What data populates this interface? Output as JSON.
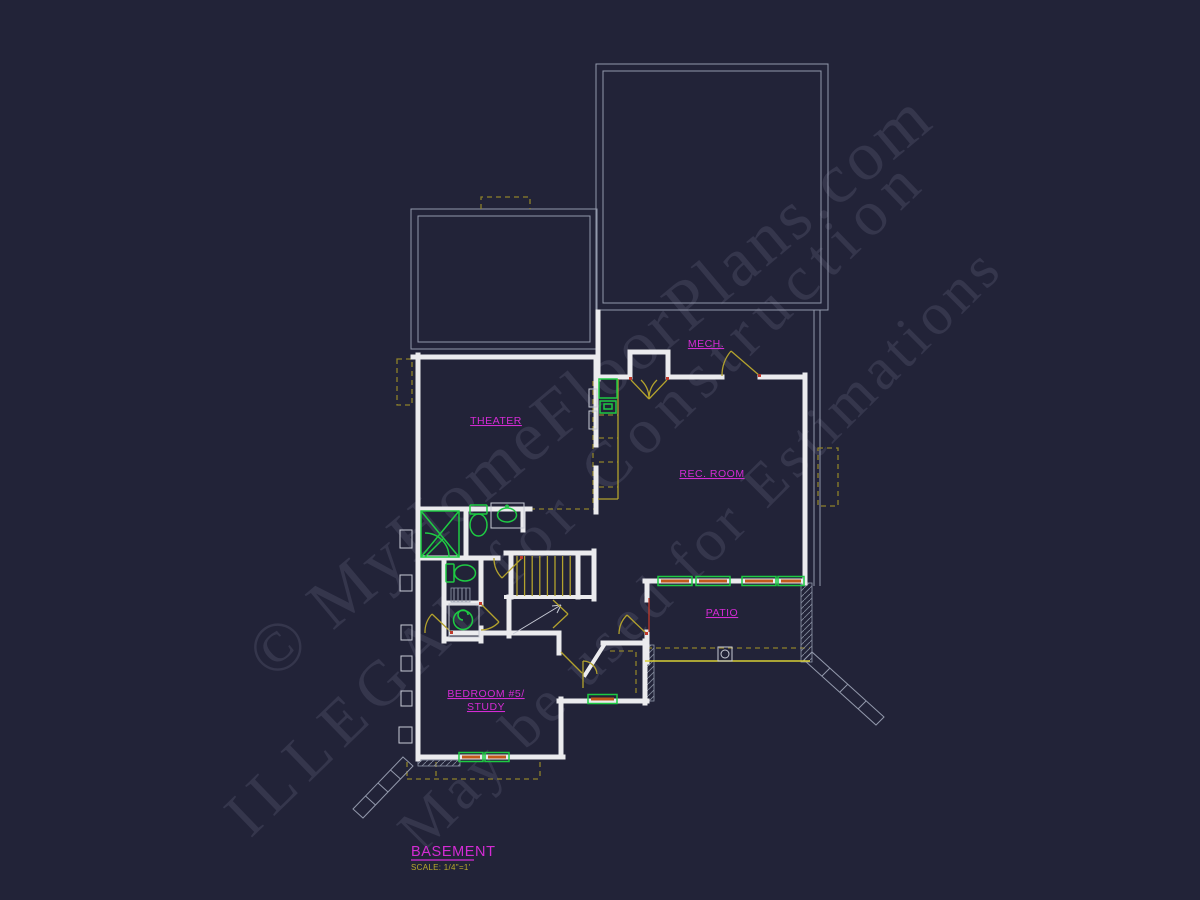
{
  "drawing": {
    "title": "BASEMENT",
    "scale_note": "SCALE: 1/4\"=1'"
  },
  "rooms": {
    "theater": "THEATER",
    "mech": "MECH.",
    "rec_room": "REC. ROOM",
    "patio": "PATIO",
    "bedroom_line1": "BEDROOM #5/",
    "bedroom_line2": "STUDY"
  },
  "watermarks": {
    "line1": "© MyHomeFloorPlans.com",
    "line2": "ILLEGAL for Construction",
    "line3": "May be used for Estimations"
  },
  "colors": {
    "bg": "#222338",
    "wall": "#ebebee",
    "outline": "#9298ab",
    "olive": "#b3a22d",
    "green": "#1ecb43",
    "orange": "#c25a1a",
    "magenta": "#d42bd4",
    "yellow": "#d8cf35",
    "scale-yellow": "#b8a92c",
    "red": "#c0392b"
  }
}
